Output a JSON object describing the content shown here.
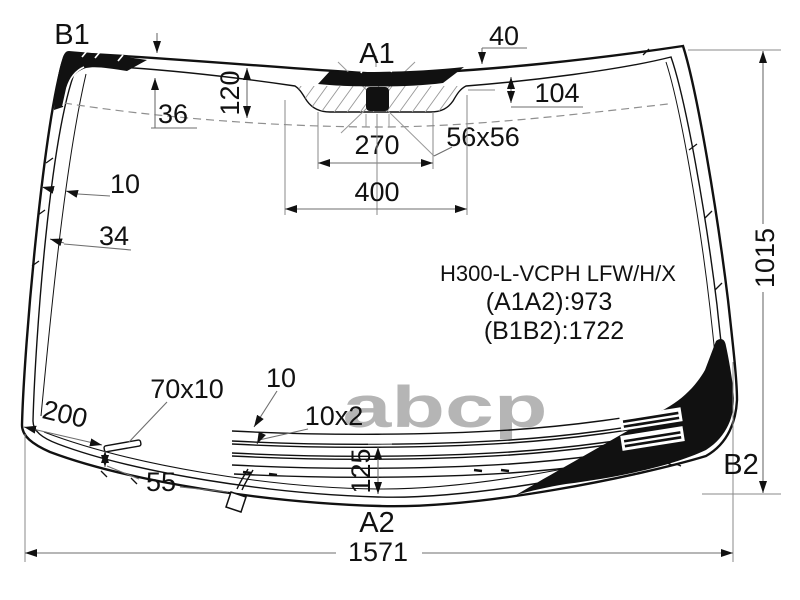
{
  "drawing": {
    "corners": {
      "b1": "B1",
      "a1": "A1",
      "a2": "A2",
      "b2": "B2"
    },
    "part_info": {
      "code": "H300-L-VCPH LFW/H/X",
      "a1a2": "(A1A2):973",
      "b1b2": "(B1B2):1722"
    },
    "dims": {
      "d36": "36",
      "d120": "120",
      "d40": "40",
      "d104": "104",
      "d270": "270",
      "d56x56": "56x56",
      "d400": "400",
      "d10_left": "10",
      "d34": "34",
      "d1015": "1015",
      "d70x10": "70x10",
      "d10_bottom": "10",
      "d200": "200",
      "d10x2": "10x2",
      "d55": "55",
      "d125": "125",
      "d1571": "1571"
    },
    "watermark": "abcp",
    "colors": {
      "ink": "#111111",
      "dimension": "#6e6e6e",
      "watermark": "#b5b5b5",
      "background": "#ffffff"
    }
  }
}
